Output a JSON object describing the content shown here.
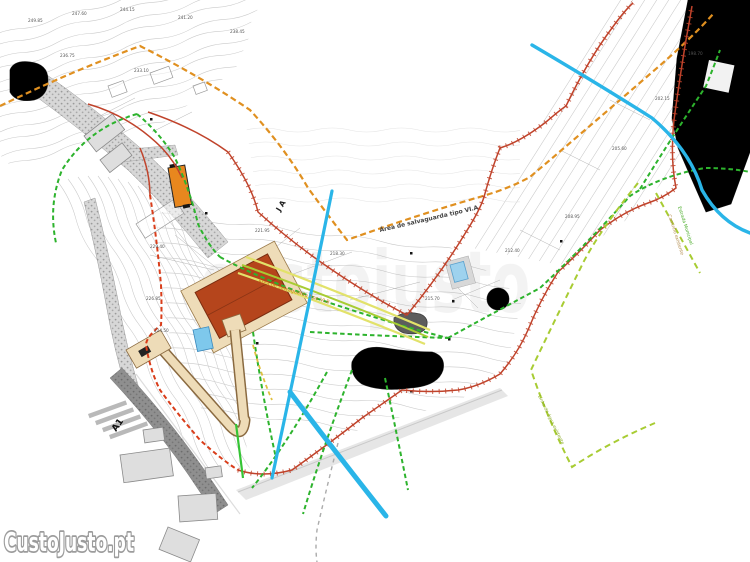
{
  "watermark": {
    "logo": "CustoJusto.pt",
    "ghost": "custojusto"
  },
  "annotations": {
    "safeguard_a": "Área de salvaguarda tipo VI.A",
    "safeguard_b": "Área de salvaguarda tipo VI.B",
    "parcel": "J A",
    "road_a1": "A1",
    "municipal_road": "Estrada Municipal",
    "path_note": "Caminho existente",
    "water_note": "Linha de água existente"
  },
  "elevations": [
    "249.85",
    "247.60",
    "244.15",
    "241.20",
    "238.45",
    "236.75",
    "233.10",
    "229.40",
    "226.85",
    "224.50",
    "221.95",
    "218.30",
    "215.70",
    "212.40",
    "208.95",
    "205.60",
    "202.15",
    "198.70"
  ],
  "colors": {
    "boundary_red": "#c0432b",
    "boundary_red_dashed": "#d93d1a",
    "safeguard_orange": "#e09020",
    "green_dashed": "#2db32d",
    "bright_green": "#35c435",
    "chartreuse": "#a8cc33",
    "yellow": "#e2e26a",
    "water_cyan": "#2ab5e8",
    "roof_terracotta": "#b5451c",
    "terrace_tan": "#eedcb8",
    "building_orange": "#e8871e",
    "pool_blue": "#7ec8ec",
    "road_gray": "#8f8f8f",
    "dark_band": "#4c4c4c",
    "contour_gray": "#c9c9c9"
  }
}
